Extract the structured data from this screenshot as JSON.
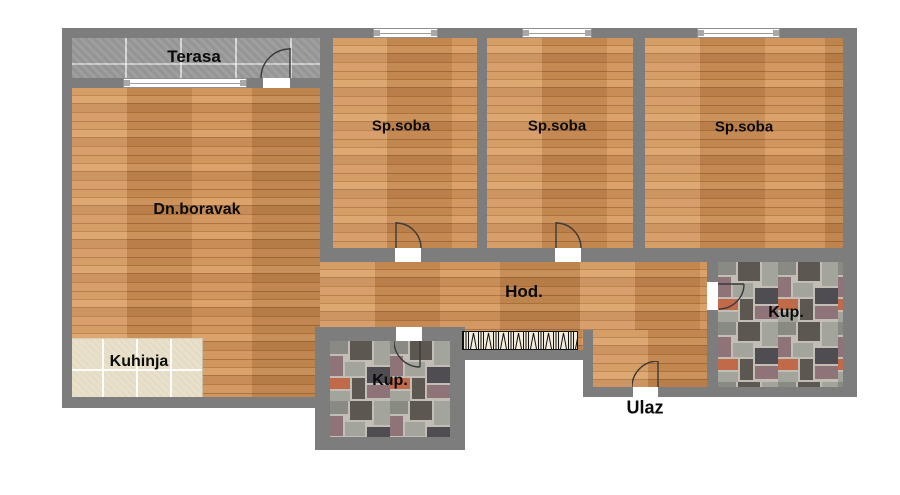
{
  "floorplan": {
    "rooms": [
      {
        "id": "terasa",
        "label": "Terasa"
      },
      {
        "id": "sp-soba-1",
        "label": "Sp.soba"
      },
      {
        "id": "sp-soba-2",
        "label": "Sp.soba"
      },
      {
        "id": "sp-soba-3",
        "label": "Sp.soba"
      },
      {
        "id": "dn-boravak",
        "label": "Dn.boravak"
      },
      {
        "id": "hodnik",
        "label": "Hod."
      },
      {
        "id": "kuhinja",
        "label": "Kuhinja"
      },
      {
        "id": "kupatilo-1",
        "label": "Kup."
      },
      {
        "id": "kupatilo-2",
        "label": "Kup."
      },
      {
        "id": "ulaz",
        "label": "Ulaz"
      }
    ],
    "colors": {
      "wall": "#7d7d7d",
      "wood_floor": "#c3854f",
      "terrace_tile": "#9b9b9b",
      "kitchen_tile": "#e8e0cb",
      "bath_tile_grout": "#c2beb5"
    }
  }
}
